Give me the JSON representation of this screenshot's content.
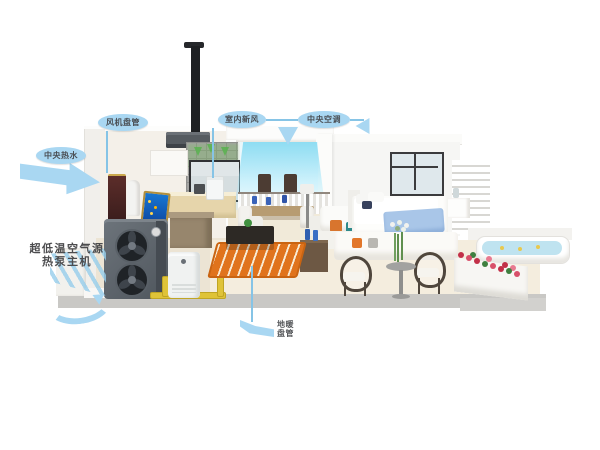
{
  "callouts": {
    "hot_water": {
      "label": "中央热水"
    },
    "fan_coil": {
      "label": "风机盘管"
    },
    "fresh_air": {
      "label": "室内新风"
    },
    "central_ac": {
      "label": "中央空调"
    },
    "heat_pump": {
      "line1": "超低温空气源",
      "line2": "热泵主机"
    },
    "floor_heating": {
      "line1": "地暖",
      "line2": "盘管"
    }
  },
  "colors": {
    "accent-blue": "#a9d7f2",
    "leader-blue": "#86c4e6",
    "label-text": "#4a4e53",
    "pipe-yellow": "#dfc338",
    "coil-orange": "#e0731c",
    "airflow-cyan": "#8fd9ef",
    "fresh-air-green": "#5cb152",
    "floor-cream": "#f4edde",
    "foundation-gray": "#c9c8c5",
    "heat-pump-gray": "#5d646b",
    "blanket-blue": "#a9c6e8",
    "flower-red": "#c23048"
  }
}
